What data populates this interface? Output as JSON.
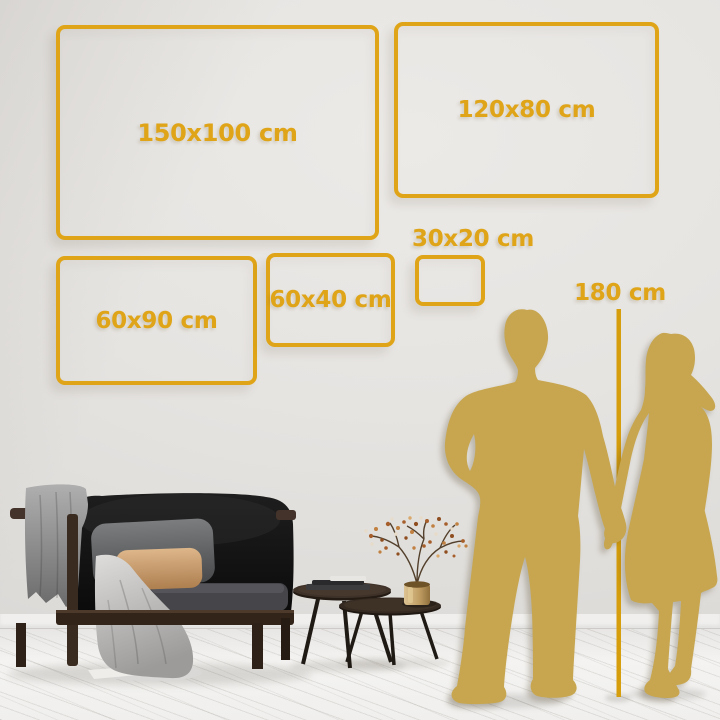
{
  "page": {
    "type": "wall-art-size-guide"
  },
  "size_frames": [
    {
      "id": "150x100",
      "label": "150x100 cm"
    },
    {
      "id": "120x80",
      "label": "120x80 cm"
    },
    {
      "id": "60x90",
      "label": "60x90 cm"
    },
    {
      "id": "60x40",
      "label": "60x40 cm"
    },
    {
      "id": "30x20",
      "label": "30x20 cm"
    }
  ],
  "height_reference": {
    "label": "180 cm"
  },
  "colors": {
    "accent_gold": "#DFA417",
    "ruler_gold": "#D69E0C",
    "silhouette_gold": "#C7A64F",
    "wall": "#E6E4E1",
    "floor": "#F3F2F0"
  },
  "scene": {
    "elements": [
      "sofa",
      "gray-blanket",
      "light-blanket",
      "pillows",
      "nesting-coffee-tables",
      "books",
      "brass-vase",
      "dried-branch-plant",
      "man-silhouette",
      "woman-silhouette",
      "height-ruler-line"
    ]
  }
}
